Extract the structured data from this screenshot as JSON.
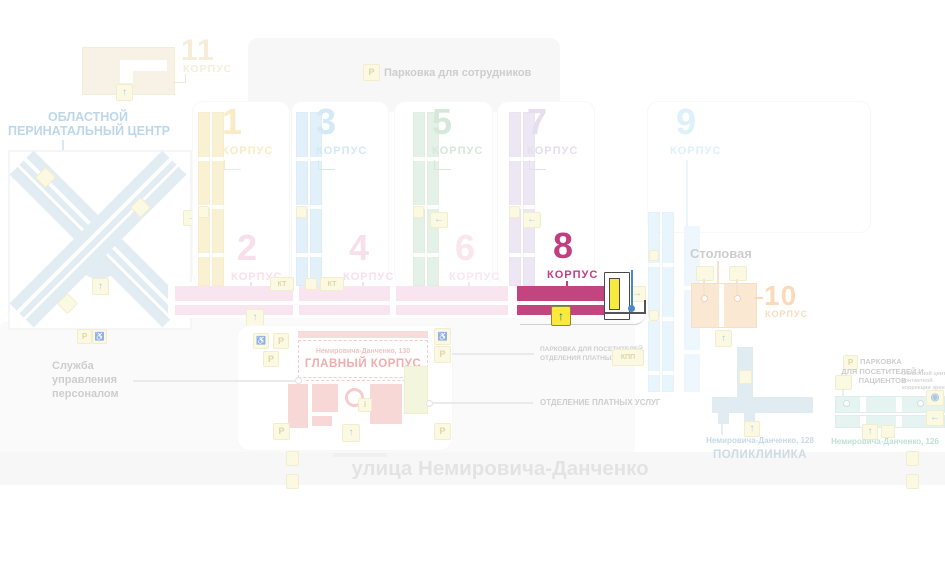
{
  "street": {
    "name": "улица Немировича-Данченко"
  },
  "employee_parking": {
    "label": "Парковка для сотрудников"
  },
  "perinatal_center": {
    "line1": "ОБЛАСТНОЙ",
    "line2": "ПЕРИНАТАЛЬНЫЙ ЦЕНТР"
  },
  "bld": {
    "1": {
      "num": "1",
      "label": "КОРПУС"
    },
    "2": {
      "num": "2",
      "label": "КОРПУС"
    },
    "3": {
      "num": "3",
      "label": "КОРПУС"
    },
    "4": {
      "num": "4",
      "label": "КОРПУС"
    },
    "5": {
      "num": "5",
      "label": "КОРПУС"
    },
    "6": {
      "num": "6",
      "label": "КОРПУС"
    },
    "7": {
      "num": "7",
      "label": "КОРПУС"
    },
    "8": {
      "num": "8",
      "label": "КОРПУС"
    },
    "9": {
      "num": "9",
      "label": "КОРПУС"
    },
    "10": {
      "num": "10",
      "label": "КОРПУС"
    },
    "11": {
      "num": "11",
      "label": "КОРПУС"
    }
  },
  "main_building": {
    "address": "Немировича-Данченко, 130",
    "name": "ГЛАВНЫЙ КОРПУС"
  },
  "canteen": {
    "label": "Столовая"
  },
  "hr_service": {
    "line1": "Служба",
    "line2": "управления",
    "line3": "персоналом"
  },
  "paid_services": {
    "parking_line1": "ПАРКОВКА ДЛЯ ПОСЕТИТЕЛЕЙ",
    "parking_line2": "ОТДЕЛЕНИЯ ПЛАТНЫХ УСЛУГ",
    "dept": "ОТДЕЛЕНИЕ ПЛАТНЫХ УСЛУГ"
  },
  "checkpoint": {
    "label": "КПП"
  },
  "polyclinic": {
    "address": "Немировича-Данченко, 128",
    "name": "ПОЛИКЛИНИКА"
  },
  "vision_center": {
    "address": "Немировича-Данченко, 126",
    "line1": "Областной центр",
    "line2": "контактной",
    "line3": "коррекции зрения"
  },
  "patient_parking": {
    "line1": "ПАРКОВКА",
    "line2": "ДЛЯ ПОСЕТИТЕЛЕЙ И ПАЦИЕНТОВ"
  },
  "icons": {
    "parking": "P",
    "ct": "КТ",
    "info": "i",
    "up_arrow": "↑",
    "right_arrow": "→",
    "left_arrow": "←",
    "wheelchair": "♿",
    "eye": "◉"
  },
  "colors": {
    "highlight": "#c2457f",
    "b1": "#f2d98e",
    "b3": "#a9d4ee",
    "b5": "#aed3b5",
    "b7": "#cfbce0",
    "b9": "#bfe3f7",
    "b10": "#f5b878",
    "b11": "#ecdcb2",
    "pink_bars": "#f5cde0",
    "main_red": "#e45c5c",
    "polyclinic_blue": "#c5d8e7",
    "teal": "#cdebe2",
    "badge_yellow": "#fbf5c8",
    "marker_blue": "#4a86c8"
  }
}
